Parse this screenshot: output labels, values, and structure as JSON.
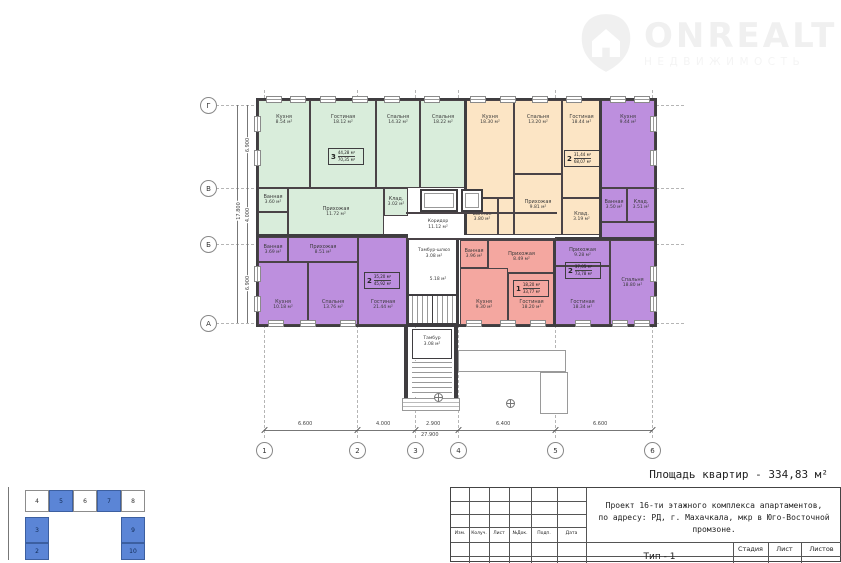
{
  "watermark": {
    "brand": "ONREALT",
    "subtitle": "НЕДВИЖИМОСТЬ"
  },
  "summary": {
    "apartments_area": "Площадь квартир - 334,83 м²"
  },
  "axes": {
    "row_labels": [
      "Г",
      "В",
      "Б",
      "А"
    ],
    "col_labels": [
      "1",
      "2",
      "3",
      "4",
      "5",
      "6"
    ],
    "col_dims": [
      "6.600",
      "4.000",
      "2.900",
      "6.400",
      "6.600"
    ],
    "col_total": "27.900",
    "row_dims": [
      "6.900",
      "4.000",
      "6.900"
    ],
    "row_total": "17.800"
  },
  "stamps": {
    "green": {
      "n": "3",
      "top": "44,28 м²",
      "bottom": "70,35 м²"
    },
    "orange": {
      "n": "2",
      "top": "31,44 м²",
      "bottom": "68,07 м²"
    },
    "purple_left": {
      "n": "2",
      "top": "35,20 м²",
      "bottom": "45,92 м²"
    },
    "pink": {
      "n": "1",
      "top": "18,20 м²",
      "bottom": "33,77 м²"
    },
    "purple_right": {
      "n": "2",
      "top": "37,05 м²",
      "bottom": "73,78 м²"
    }
  },
  "rooms": {
    "g_kitchen": {
      "name": "Кухня",
      "area": "8.54 м²"
    },
    "g_living": {
      "name": "Гостиная",
      "area": "18.12 м²"
    },
    "g_bed1": {
      "name": "Спальня",
      "area": "14.32 м²"
    },
    "g_bed2": {
      "name": "Спальня",
      "area": "18.22 м²"
    },
    "g_bath": {
      "name": "Ванная",
      "area": "3.60 м²"
    },
    "g_hall": {
      "name": "Прихожая",
      "area": "11.72 м²"
    },
    "g_klad": {
      "name": "Клад.",
      "area": "3.02 м²"
    },
    "o_kitchen": {
      "name": "Кухня",
      "area": "18.30 м²"
    },
    "o_bed": {
      "name": "Спальня",
      "area": "13.20 м²"
    },
    "o_living": {
      "name": "Гостиная",
      "area": "18.44 м²"
    },
    "o_hall": {
      "name": "Прихожая",
      "area": "9.81 м²"
    },
    "o_bath": {
      "name": "Ванная",
      "area": "3.80 м²"
    },
    "o_klad": {
      "name": "Клад.",
      "area": "3.19 м²"
    },
    "p_kitchen": {
      "name": "Кухня",
      "area": "9.44 м²"
    },
    "p_bath": {
      "name": "Ванная",
      "area": "3.50 м²"
    },
    "p_klad": {
      "name": "Клад.",
      "area": "3.51 м²"
    },
    "p_hall": {
      "name": "Прихожая",
      "area": "9.28 м²"
    },
    "p_living": {
      "name": "Гостиная",
      "area": "18.34 м²"
    },
    "p_bed": {
      "name": "Спальня",
      "area": "18.80 м²"
    },
    "q_bath": {
      "name": "Ванная",
      "area": "3.69 м²"
    },
    "q_hall": {
      "name": "Прихожая",
      "area": "8.51 м²"
    },
    "q_kitchen": {
      "name": "Кухня",
      "area": "10.18 м²"
    },
    "q_bed": {
      "name": "Спальня",
      "area": "13.76 м²"
    },
    "q_living": {
      "name": "Гостиная",
      "area": "21.44 м²"
    },
    "k_bath": {
      "name": "Ванная",
      "area": "3.96 м²"
    },
    "k_hall": {
      "name": "Прихожая",
      "area": "8.49 м²"
    },
    "k_kitchen": {
      "name": "Кухня",
      "area": "9.30 м²"
    },
    "k_living": {
      "name": "Гостиная",
      "area": "18.20 м²"
    }
  },
  "common": {
    "corridor": {
      "name": "Коридор",
      "area": "11.12 м²"
    },
    "tambur_shluz": {
      "name": "Тамбур-шлюз",
      "area": "3.08 м²"
    },
    "lift_lobby": {
      "area": "5.18 м²"
    },
    "tambur": {
      "name": "Тамбур",
      "area": "3.08 м²"
    }
  },
  "schematic": {
    "blocks": [
      {
        "label": "4",
        "filled": false
      },
      {
        "label": "5",
        "filled": true
      },
      {
        "label": "6",
        "filled": false
      },
      {
        "label": "7",
        "filled": true
      },
      {
        "label": "8",
        "filled": false
      },
      {
        "label": "3",
        "filled": true
      },
      {
        "label": "2",
        "filled": true
      },
      {
        "label": "9",
        "filled": true
      },
      {
        "label": "10",
        "filled": true
      }
    ]
  },
  "title_block": {
    "project_line1": "Проект 16-ти этажного комплекса апартаментов,",
    "project_line2": "по адресу: РД, г. Махачкала, мкр в Юго-Восточной промзоне.",
    "revision_headers": [
      "Изм.",
      "Колуч.",
      "Лист",
      "№Док.",
      "Подп.",
      "Дата"
    ],
    "stage_headers": [
      "Стадия",
      "Лист",
      "Листов"
    ],
    "sheet_title": "Тип - 1"
  },
  "colors": {
    "apartment_green": "#d9eddb",
    "apartment_orange": "#fce5c5",
    "apartment_purple": "#bd8fde",
    "apartment_pink": "#f4a7a0",
    "wall": "#3f3d40",
    "schematic_blue": "#5b85d6"
  }
}
